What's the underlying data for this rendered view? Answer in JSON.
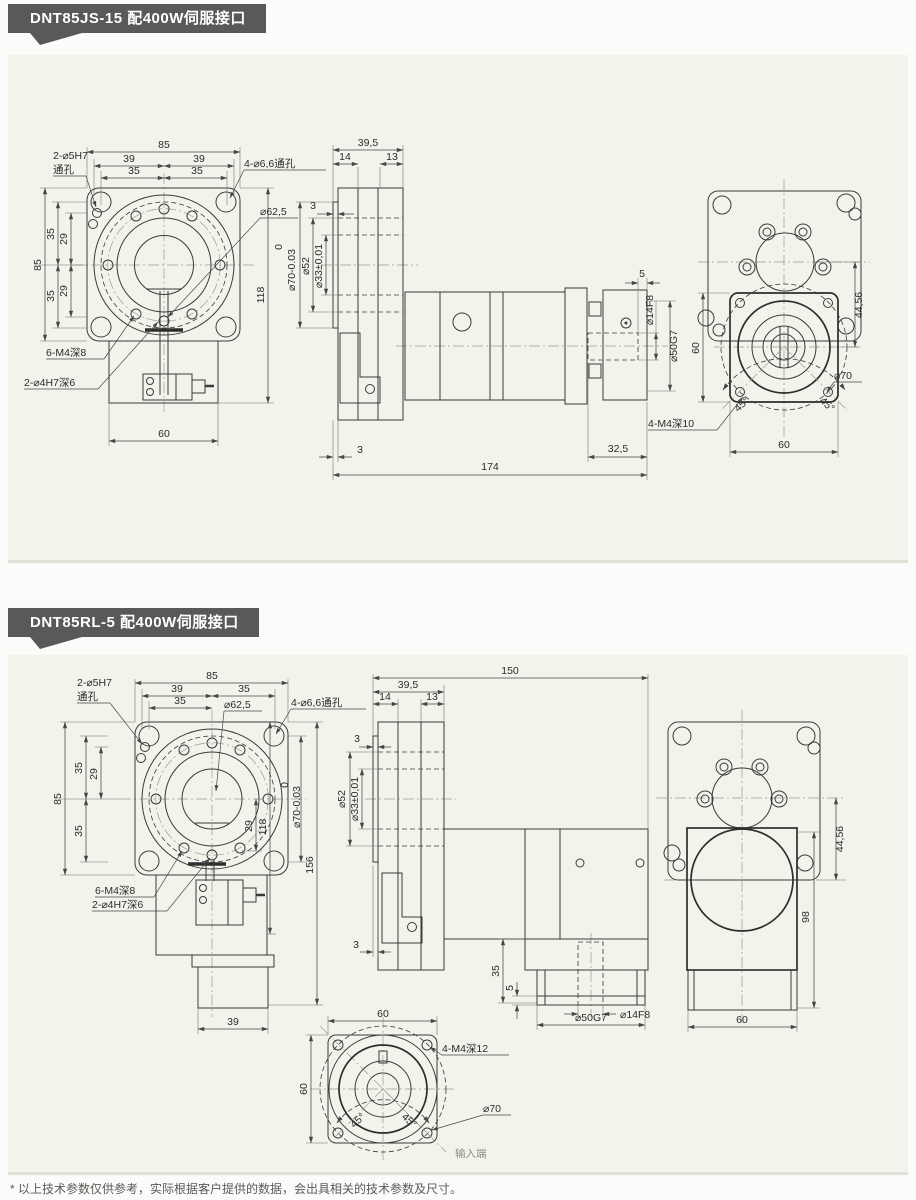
{
  "theme": {
    "badge_bg": "#59595a",
    "panel_bg": "#f3f3ec",
    "page_bg": "#fbfbf9",
    "line": "#3a3a3a"
  },
  "page": {
    "footnote": "* 以上技术参数仅供参考，实际根据客户提供的数据，会出具相关的技术参数及尺寸。"
  },
  "sections": [
    {
      "title": "DNT85JS-15 配400W伺服接口",
      "front": {
        "t85": "85",
        "t39a": "39",
        "t39b": "39",
        "t35a": "35",
        "t35b": "35",
        "l5h7": "2-⌀5H7",
        "lthru": "通孔",
        "l66": "4-⌀6,6通孔",
        "l625": "⌀62,5",
        "s85": "85",
        "s35a": "35",
        "s29a": "29",
        "s35b": "35",
        "s29b": "29",
        "r118": "118",
        "l6m4": "6-M4深8",
        "l4h7": "2-⌀4H7深6",
        "b60": "60"
      },
      "side": {
        "t395": "39,5",
        "t14": "14",
        "t13": "13",
        "t3": "3",
        "tol0": "0",
        "tol70": "⌀70-0.03",
        "d52": "⌀52",
        "d33": "⌀33±0,01",
        "r5": "5",
        "d14": "⌀14F8",
        "d50": "⌀50G7",
        "b3": "3",
        "b325": "32,5",
        "b174": "174"
      },
      "rear": {
        "v4456": "44,56",
        "l4m4": "4-M4深10",
        "a45l": "45°",
        "a45r": "45°",
        "d70": "⌀70",
        "l60": "60",
        "b60": "60"
      }
    },
    {
      "title": "DNT85RL-5 配400W伺服接口",
      "front": {
        "t85": "85",
        "t39": "39",
        "t35r": "35",
        "t35l": "35",
        "l5h7": "2-⌀5H7",
        "lthru": "通孔",
        "l625": "⌀62,5",
        "l66": "4-⌀6,6通孔",
        "s85": "85",
        "s35a": "35",
        "s29a": "29",
        "s35b": "35",
        "r29": "29",
        "r118": "118",
        "tol0": "0",
        "tol70": "⌀70-0.03",
        "r156": "156",
        "l6m4": "6-M4深8",
        "l4h7": "2-⌀4H7深6",
        "b39": "39"
      },
      "side": {
        "t150": "150",
        "t395": "39,5",
        "t14": "14",
        "t13": "13",
        "t3": "3",
        "d52": "⌀52",
        "d33": "⌀33±0,01",
        "b3": "3",
        "v35": "35",
        "v5": "5",
        "d14": "⌀14F8",
        "d50": "⌀50G7"
      },
      "bottom": {
        "t60": "60",
        "l60": "60",
        "l4m4": "4-M4深12",
        "d70": "⌀70",
        "a45l": "45°",
        "a45r": "45°",
        "input": "输入端"
      },
      "rear": {
        "v4456": "44,56",
        "v98": "98",
        "b60": "60"
      }
    }
  ]
}
